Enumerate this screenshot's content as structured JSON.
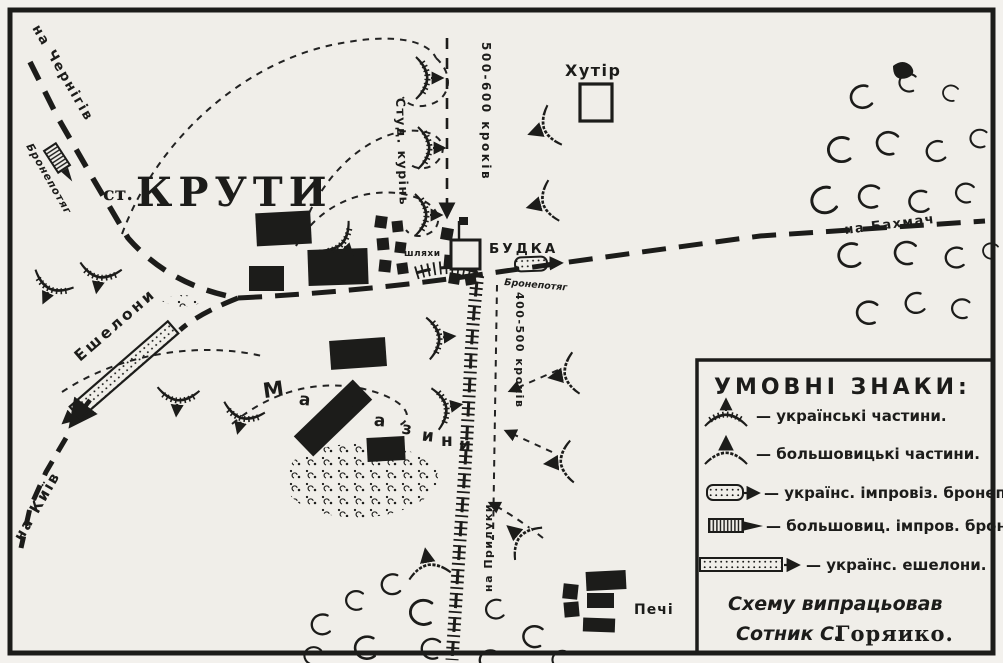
{
  "map": {
    "colors": {
      "ink": "#1c1c1a",
      "paper": "#f0eee9"
    },
    "labels": {
      "station_prefix": "ст.",
      "station_name": "КРУТИ",
      "to_chernihiv": "на Чернігів",
      "bronepotiah_nw": "Бронепотяг",
      "stud_kurin": "Студ. курінь",
      "steps_north": "500-600 кроків",
      "steps_south": "400-500 кроків",
      "khutir": "Хутір",
      "budka": "БУДКА",
      "bronepotiah_e": "Бронепотяг",
      "to_bakhmach": "на Бахмач",
      "shliakhy": "шляхи",
      "eshelony": "Ешелони",
      "to_kyiv": "на Київ",
      "to_pryluky": "на Прилуки",
      "pechi": "Печі",
      "magazines": [
        "М",
        "а",
        "г",
        "а",
        "з",
        "и",
        "н",
        "и"
      ]
    },
    "legend": {
      "title": "УМОВНІ ЗНАКИ:",
      "items": [
        {
          "symbol": "ukrainian-unit",
          "label": "— українські частини."
        },
        {
          "symbol": "bolshevik-unit",
          "label": "— большовицькі частини."
        },
        {
          "symbol": "ukrainian-improvised-armored-train",
          "label": "— українс. імпровіз. бронепотяг."
        },
        {
          "symbol": "bolshevik-improvised-armored-train",
          "label": "— большовиц. імпров. бронепотяг."
        },
        {
          "symbol": "ukrainian-echelons",
          "label": "— українс. ешелони."
        }
      ],
      "credit_line1": "Схему випрацьовав",
      "credit_line2a": "Сотник С.",
      "credit_line2b": "Горяико."
    }
  }
}
